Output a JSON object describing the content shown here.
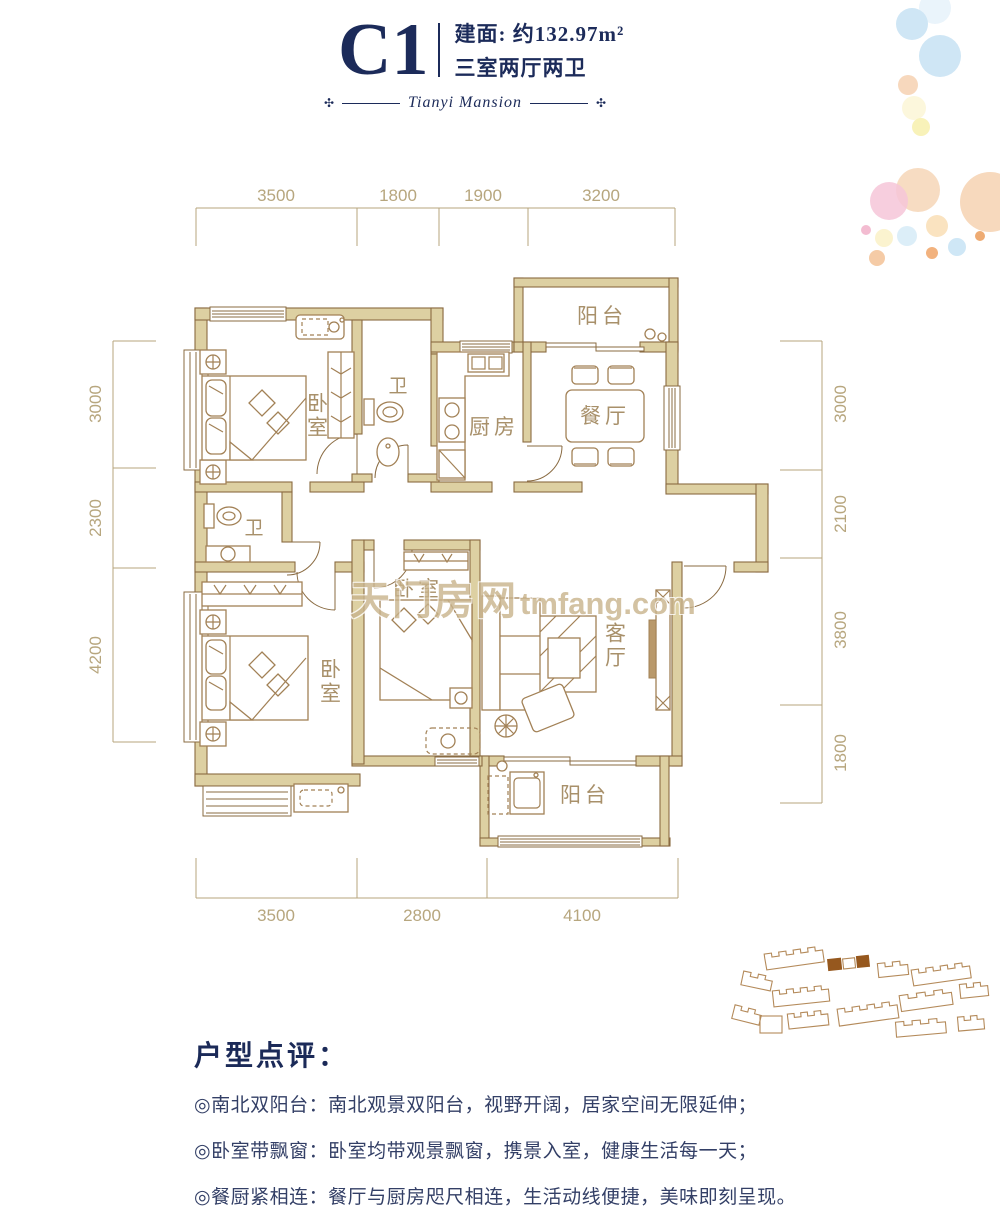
{
  "header": {
    "unit_code": "C1",
    "area": "建面: 约132.97m²",
    "layout": "三室两厅两卫",
    "brand_script": "Tianyi Mansion",
    "ornament": "✣"
  },
  "dimensions": {
    "top": [
      "3500",
      "1800",
      "1900",
      "3200"
    ],
    "left": [
      "3000",
      "2300",
      "4200"
    ],
    "right": [
      "3000",
      "2100",
      "3800",
      "1800"
    ],
    "bottom": [
      "3500",
      "2800",
      "4100"
    ]
  },
  "room_labels": {
    "balcony_north": "阳台",
    "dining": "餐厅",
    "kitchen": "厨房",
    "bath_top": "卫",
    "bedroom_master": "卧室",
    "bath_mid": "卫",
    "bedroom_left": "卧室",
    "bedroom_mid": "卧室",
    "living": "客厅",
    "balcony_south": "阳台"
  },
  "watermark": {
    "cn": "天门房网",
    "en": "tmfang.com"
  },
  "review": {
    "heading": "户型点评：",
    "items": [
      "◎南北双阳台：南北观景双阳台，视野开阔，居家空间无限延伸；",
      "◎卧室带飘窗：卧室均带观景飘窗，携景入室，健康生活每一天；",
      "◎餐厨紧相连：餐厅与厨房咫尺相连，生活动线便捷，美味即刻呈现。"
    ]
  },
  "colors": {
    "header_navy": "#1c2b5a",
    "review_text": "#333f66",
    "wall_fill": "#ddd0a2",
    "wall_stroke": "#8a6b42",
    "furniture": "#a28156",
    "dimension": "#b7a67e",
    "room_label": "#a8906a",
    "watermark": "#c9b48c",
    "site_outline": "#b48a5a",
    "site_highlight": "#96581e"
  }
}
